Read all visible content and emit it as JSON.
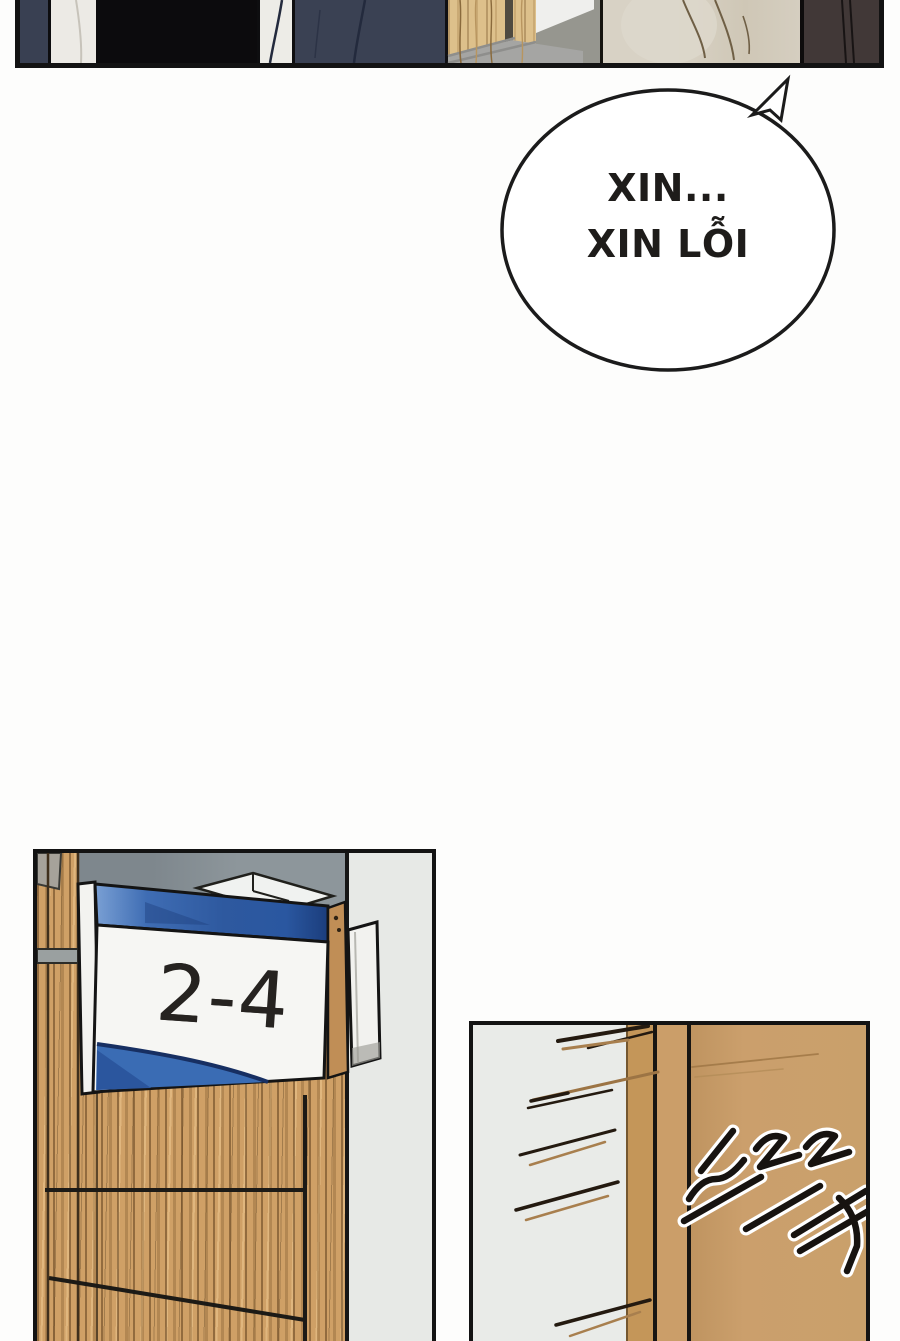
{
  "page": {
    "background": "#fdfdfc",
    "panel_border": "#131313"
  },
  "speech_bubble": {
    "line1": "XIN...",
    "line2": "XIN LỖI"
  },
  "sign_panel": {
    "sign_label": "2-4",
    "colors": {
      "wood": "#cfa066",
      "sign_blue": "#3a6cb4",
      "sign_blue_dark": "#172f62",
      "sign_face": "#f6f6f3",
      "wall_gray_blue": "#8d969b",
      "side_wall": "#e7e9e6"
    }
  },
  "door_panel": {
    "sfx_text": "드르륵",
    "colors": {
      "wall": "#e9ebe8",
      "door": "#c9a06b",
      "frame": "#c49659",
      "speedline_dark": "#241a10",
      "speedline_tan": "#a87f4e"
    }
  },
  "top_panel": {
    "colors": {
      "navy_suit": "#3a4153",
      "shirt": "#edece7",
      "black_garment": "#0c0b0d",
      "wood_door": "#ddc08b",
      "wall_gray": "#96968f",
      "coat_beige": "#d5cec0",
      "jacket_dark_brown": "#413837"
    }
  }
}
